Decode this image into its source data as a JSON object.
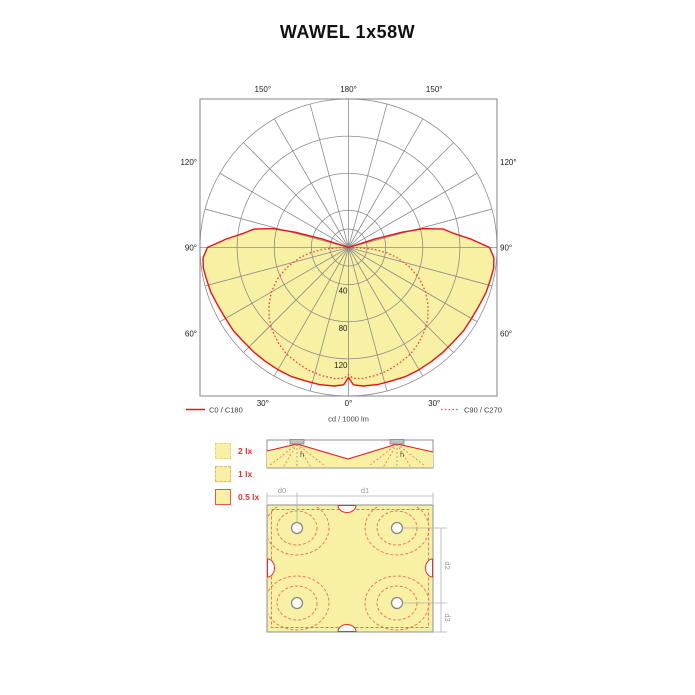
{
  "title": "WAWEL 1x58W",
  "polar": {
    "unit_label": "cd / 1000 lm",
    "legend": [
      {
        "label": "C0 / C180",
        "style": "solid",
        "color": "#e81414"
      },
      {
        "label": "C90 / C270",
        "style": "dotted",
        "color": "#f05050"
      }
    ]
  },
  "chart_data": {
    "type": "polar_intensity",
    "title": "WAWEL 1x58W",
    "unit": "cd / 1000 lm",
    "grid_circles": [
      20,
      40,
      80,
      120,
      160
    ],
    "radial_tick_labels": [
      "40",
      "80",
      "120"
    ],
    "angle_step_deg": 15,
    "angle_tick_labels": [
      "180°",
      "150°",
      "150°",
      "120°",
      "120°",
      "90°",
      "90°",
      "60°",
      "60°",
      "30°",
      "30°",
      "0°"
    ],
    "symmetric_mirror": true,
    "series": [
      {
        "name": "C0 / C180",
        "style": "solid",
        "color": "#e81414",
        "points": [
          [
            0,
            140
          ],
          [
            2,
            148
          ],
          [
            6,
            150
          ],
          [
            12,
            151
          ],
          [
            18,
            151
          ],
          [
            24,
            152
          ],
          [
            30,
            152
          ],
          [
            36,
            152
          ],
          [
            42,
            152
          ],
          [
            48,
            152
          ],
          [
            54,
            153
          ],
          [
            60,
            153
          ],
          [
            66,
            154
          ],
          [
            72,
            156
          ],
          [
            78,
            157
          ],
          [
            82,
            158
          ],
          [
            86,
            157
          ],
          [
            90,
            152
          ],
          [
            94,
            132
          ],
          [
            98,
            113
          ],
          [
            101,
            104
          ],
          [
            104,
            84
          ],
          [
            106,
            60
          ],
          [
            108,
            30
          ],
          [
            109,
            0
          ]
        ]
      },
      {
        "name": "C90 / C270",
        "style": "dotted",
        "color": "#f04040",
        "points": [
          [
            0,
            137
          ],
          [
            2,
            141
          ],
          [
            6,
            142
          ],
          [
            12,
            141
          ],
          [
            18,
            139
          ],
          [
            24,
            136
          ],
          [
            30,
            133
          ],
          [
            36,
            128
          ],
          [
            42,
            122
          ],
          [
            48,
            115
          ],
          [
            54,
            106
          ],
          [
            60,
            96
          ],
          [
            66,
            84
          ],
          [
            72,
            70
          ],
          [
            78,
            54
          ],
          [
            82,
            42
          ],
          [
            86,
            28
          ],
          [
            89,
            10
          ],
          [
            90,
            0
          ]
        ]
      }
    ]
  },
  "lux_legend": [
    {
      "label": "2 lx",
      "border": "dashed-yellow"
    },
    {
      "label": "1 lx",
      "border": "dashed-orange"
    },
    {
      "label": "0.5 lx",
      "border": "solid-red"
    }
  ],
  "section": {
    "h_label": "h"
  },
  "plan": {
    "dims": {
      "d0": "d0",
      "d1": "d1",
      "d2": "d2",
      "d3": "d3"
    }
  },
  "colors": {
    "fill_yellow": "#f8f0a2",
    "curve_solid": "#e81414",
    "curve_dotted": "#f04040",
    "grid": "#8c8c8c",
    "frame": "#999999",
    "lux_label_red": "#e83030"
  }
}
